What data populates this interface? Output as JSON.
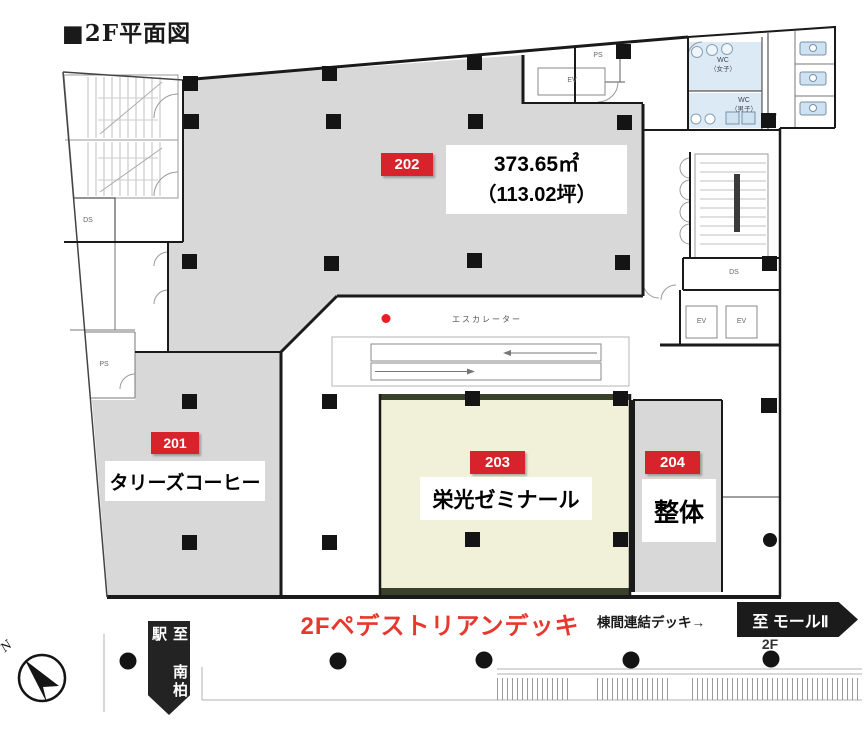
{
  "title": "■2F平面図",
  "rooms": {
    "r202": {
      "badge": "202",
      "area_m2": "373.65㎡",
      "area_tsubo": "（113.02坪）"
    },
    "r201": {
      "badge": "201",
      "name": "タリーズコーヒー"
    },
    "r203": {
      "badge": "203",
      "name": "栄光ゼミナール"
    },
    "r204": {
      "badge": "204",
      "name": "整体"
    }
  },
  "labels": {
    "escalator": "エスカレーター",
    "wc_women_top": "WC",
    "wc_women_bottom": "（女子）",
    "wc_men_top": "WC",
    "wc_men_bottom": "（男子）"
  },
  "core": {
    "ds_left": "DS",
    "ps_left": "PS",
    "ps_top": "PS",
    "ev_top": "EV",
    "ds_right": "DS",
    "ev_right_a": "EV",
    "ev_right_b": "EV"
  },
  "deck": {
    "pedestrian": "2Fペデストリアンデッキ",
    "bridge": "棟間連結デッキ→",
    "to_mall": "至 モールⅡ",
    "floor": "2F",
    "to_station": "至 南柏駅"
  },
  "compass": {
    "north": "N"
  },
  "colors": {
    "badge_red": "#d7232b",
    "deck_text_red": "#e8382d",
    "room_gray": "#d8d8d8",
    "room_cream": "#f1f1da",
    "wc_blue": "#dceaf6",
    "band_olive": "#39402b",
    "wall_black": "#1a1a1a"
  }
}
